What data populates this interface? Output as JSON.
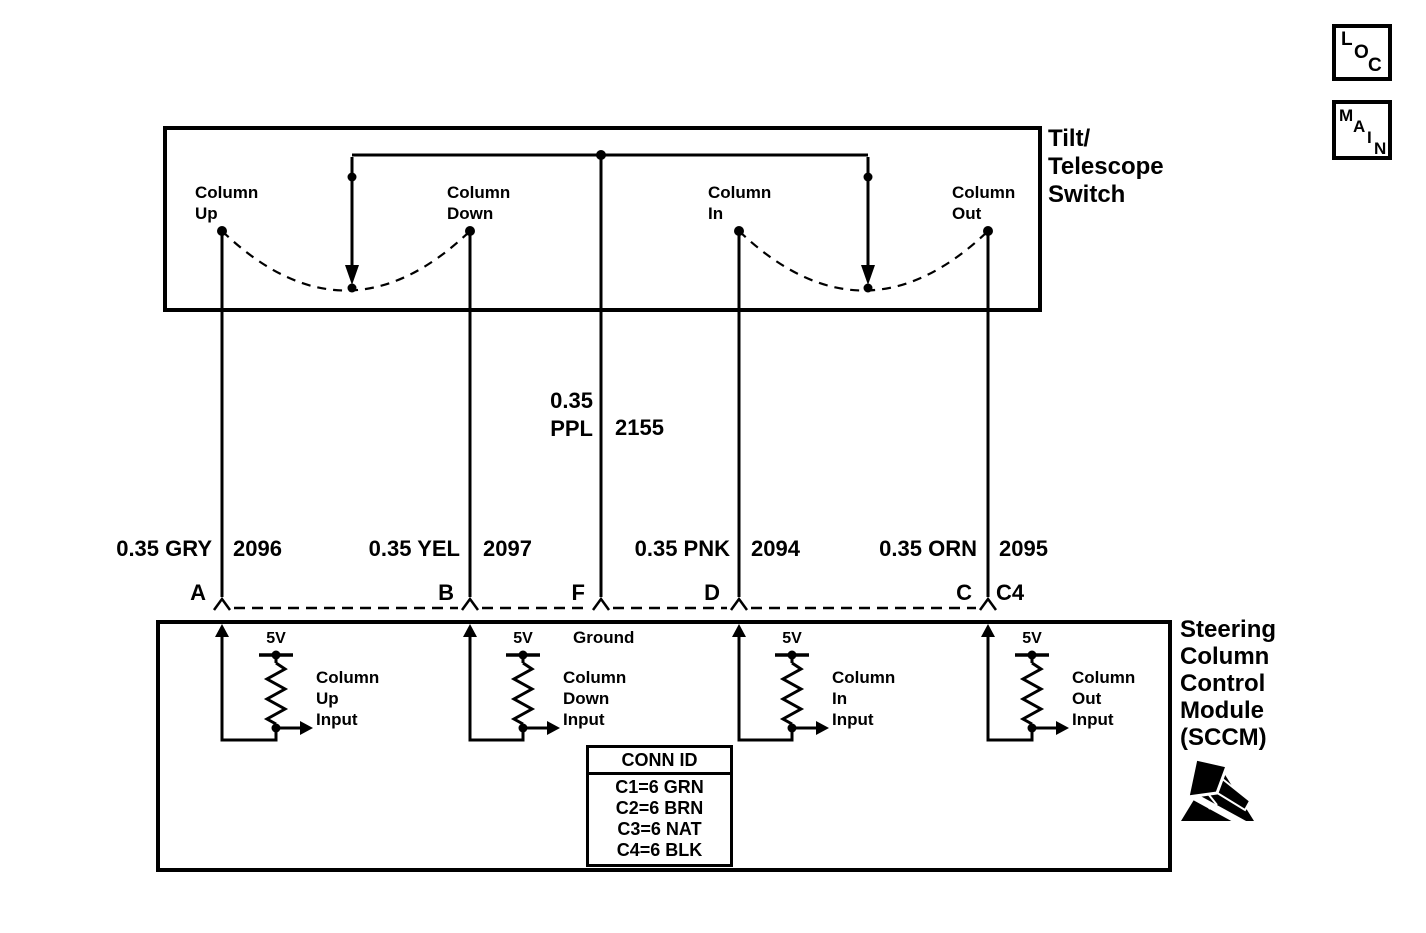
{
  "diagram": {
    "colors": {
      "line": "#000000",
      "background": "#ffffff"
    },
    "ref_tags": {
      "loc": {
        "letters": [
          "L",
          "O",
          "C"
        ]
      },
      "main": {
        "letters": [
          "M",
          "A",
          "I",
          "N"
        ]
      }
    },
    "tilt_switch": {
      "title_lines": [
        "Tilt/",
        "Telescope",
        "Switch"
      ],
      "contacts": [
        {
          "lines": [
            "Column",
            "Up"
          ]
        },
        {
          "lines": [
            "Column",
            "Down"
          ]
        },
        {
          "lines": [
            "Column",
            "In"
          ]
        },
        {
          "lines": [
            "Column",
            "Out"
          ]
        }
      ]
    },
    "wires": {
      "a": {
        "label": "0.35 GRY",
        "circuit": "2096",
        "pin": "A"
      },
      "b": {
        "label": "0.35 YEL",
        "circuit": "2097",
        "pin": "B"
      },
      "f": {
        "label_lines": [
          "0.35",
          "PPL"
        ],
        "circuit": "2155",
        "pin": "F"
      },
      "d": {
        "label": "0.35 PNK",
        "circuit": "2094",
        "pin": "D"
      },
      "c": {
        "label": "0.35 ORN",
        "circuit": "2095",
        "pin": "C"
      }
    },
    "connector_id": "C4",
    "sccm": {
      "title_lines": [
        "Steering",
        "Column",
        "Control",
        "Module",
        "(SCCM)"
      ],
      "ground_label": "Ground",
      "supply_label": "5V",
      "inputs": [
        {
          "lines": [
            "Column",
            "Up",
            "Input"
          ]
        },
        {
          "lines": [
            "Column",
            "Down",
            "Input"
          ]
        },
        {
          "lines": [
            "Column",
            "In",
            "Input"
          ]
        },
        {
          "lines": [
            "Column",
            "Out",
            "Input"
          ]
        }
      ],
      "conn_table": {
        "header": "CONN ID",
        "rows": [
          "C1=6 GRN",
          "C2=6 BRN",
          "C3=6 NAT",
          "C4=6 BLK"
        ]
      }
    }
  }
}
